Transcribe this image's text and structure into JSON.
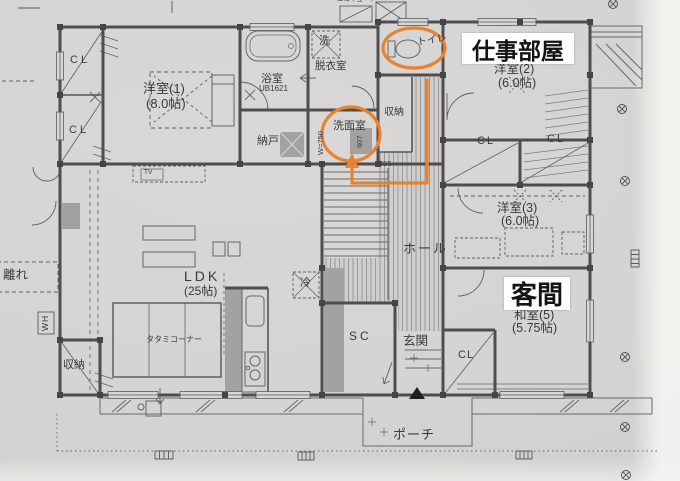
{
  "annotations": {
    "work_room": "仕事部屋",
    "guest_room": "客間",
    "highlight_color": "#e8822f"
  },
  "rooms": {
    "yoshitsu1": "洋室(1)",
    "yoshitsu1_size": "(8.0帖)",
    "bath": "浴室",
    "bath_model": "UB1621",
    "laundry": "洗",
    "dressing": "脱衣室",
    "toilet": "トイレ",
    "nando": "納戸",
    "senmen": "洗面室",
    "closet_hall": "収納",
    "yoshitsu2": "洋室(2)",
    "yoshitsu2_size": "(6.0帖)",
    "yoshitsu3": "洋室(3)",
    "yoshitsu3_size": "(6.0帖)",
    "washitsu": "和室(5)",
    "washitsu_size": "(5.75帖)",
    "ldk": "LDK",
    "ldk_size": "(25帖)",
    "tatami_corner": "タタミコーナー",
    "hall": "ホール",
    "genkan": "玄関",
    "shoe_closet": "SC",
    "porch": "ポーチ",
    "closet_west": "収納",
    "hanare": "離れ",
    "fridge": "冷",
    "water_heater": "WH",
    "tv": "TV",
    "ecocute": "エコキュート"
  },
  "closet_labels": [
    "CL",
    "CL",
    "CL",
    "CL",
    "CL"
  ],
  "dimensions": {
    "d607": "607",
    "d455": "455",
    "w750": "W=750"
  }
}
